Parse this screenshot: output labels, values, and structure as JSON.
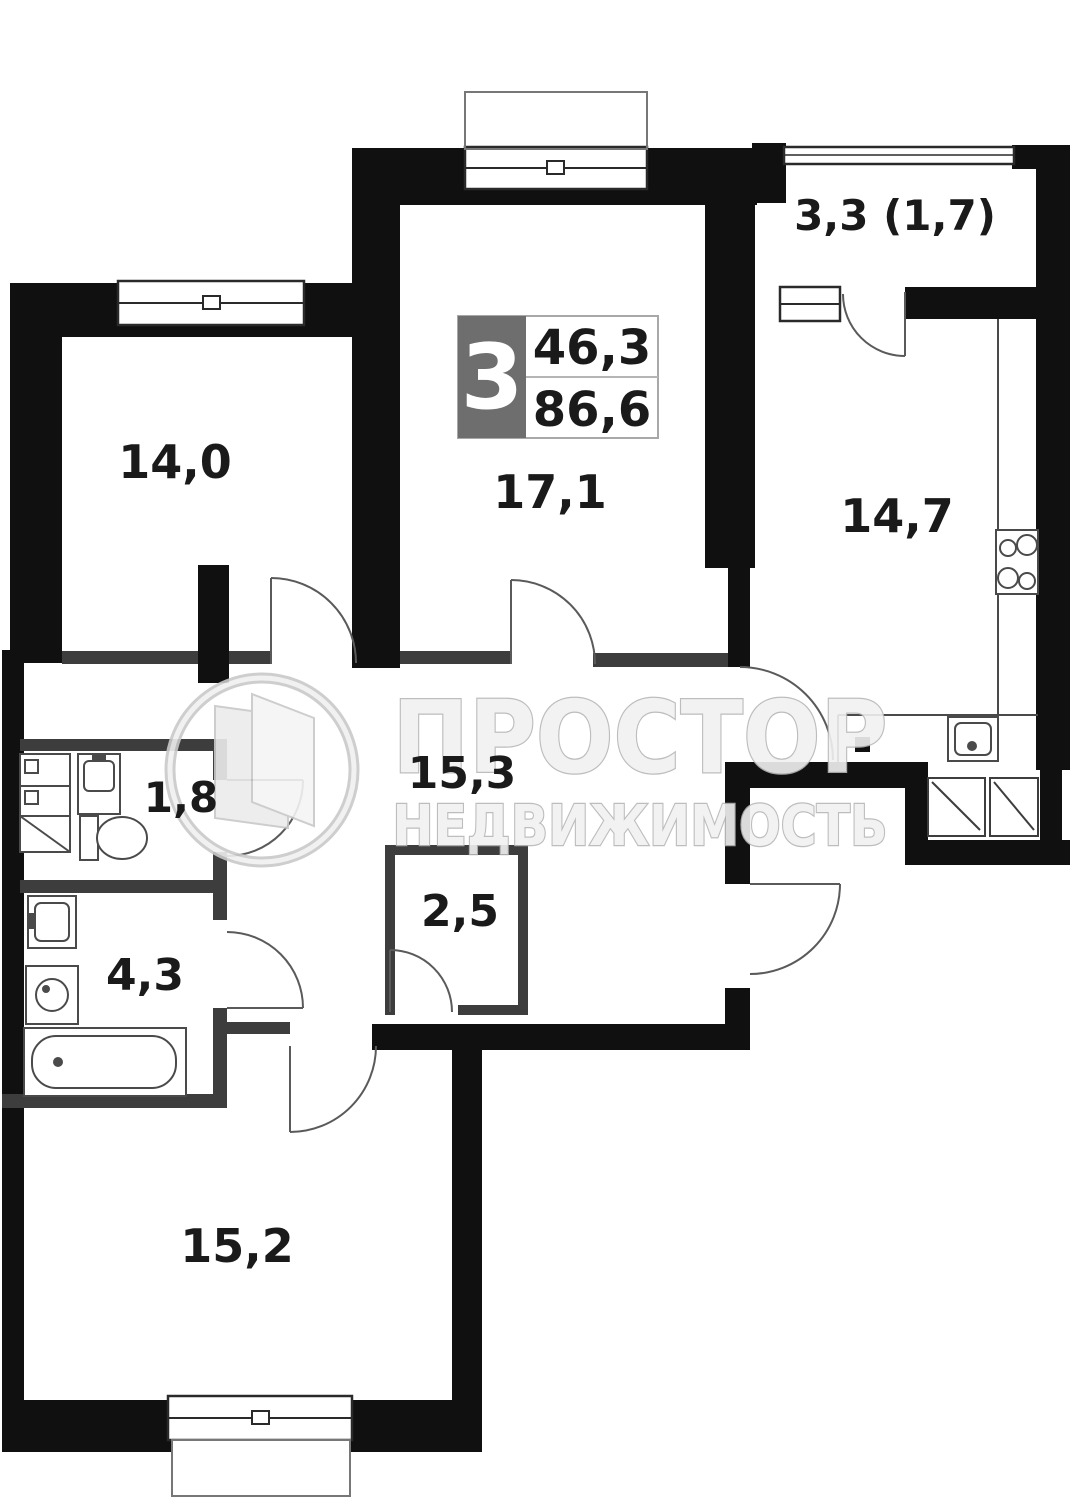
{
  "floor_plan": {
    "info_box": {
      "room_count": "3",
      "value_top": "46,3",
      "value_bottom": "86,6"
    },
    "labels": {
      "room_top_left": "14,0",
      "room_top_middle": "17,1",
      "balcony": "3,3  (1,7)",
      "kitchen": "14,7",
      "hallway": "15,3",
      "wc": "1,8",
      "storage": "2,5",
      "bathroom": "4,3",
      "room_bottom": "15,2"
    },
    "watermark": {
      "line1": "ПРОСТОР",
      "line2": "НЕДВИЖИМОСТЬ"
    },
    "colors": {
      "wall": "#101010",
      "partition": "#3d3d3d",
      "fixture_stroke": "#4a4a4a",
      "info_box_fill": "#6e6e6e",
      "label_text": "#1a1a1a",
      "watermark_fill": "#f1f1f1",
      "watermark_stroke": "#b6b6b6"
    }
  }
}
